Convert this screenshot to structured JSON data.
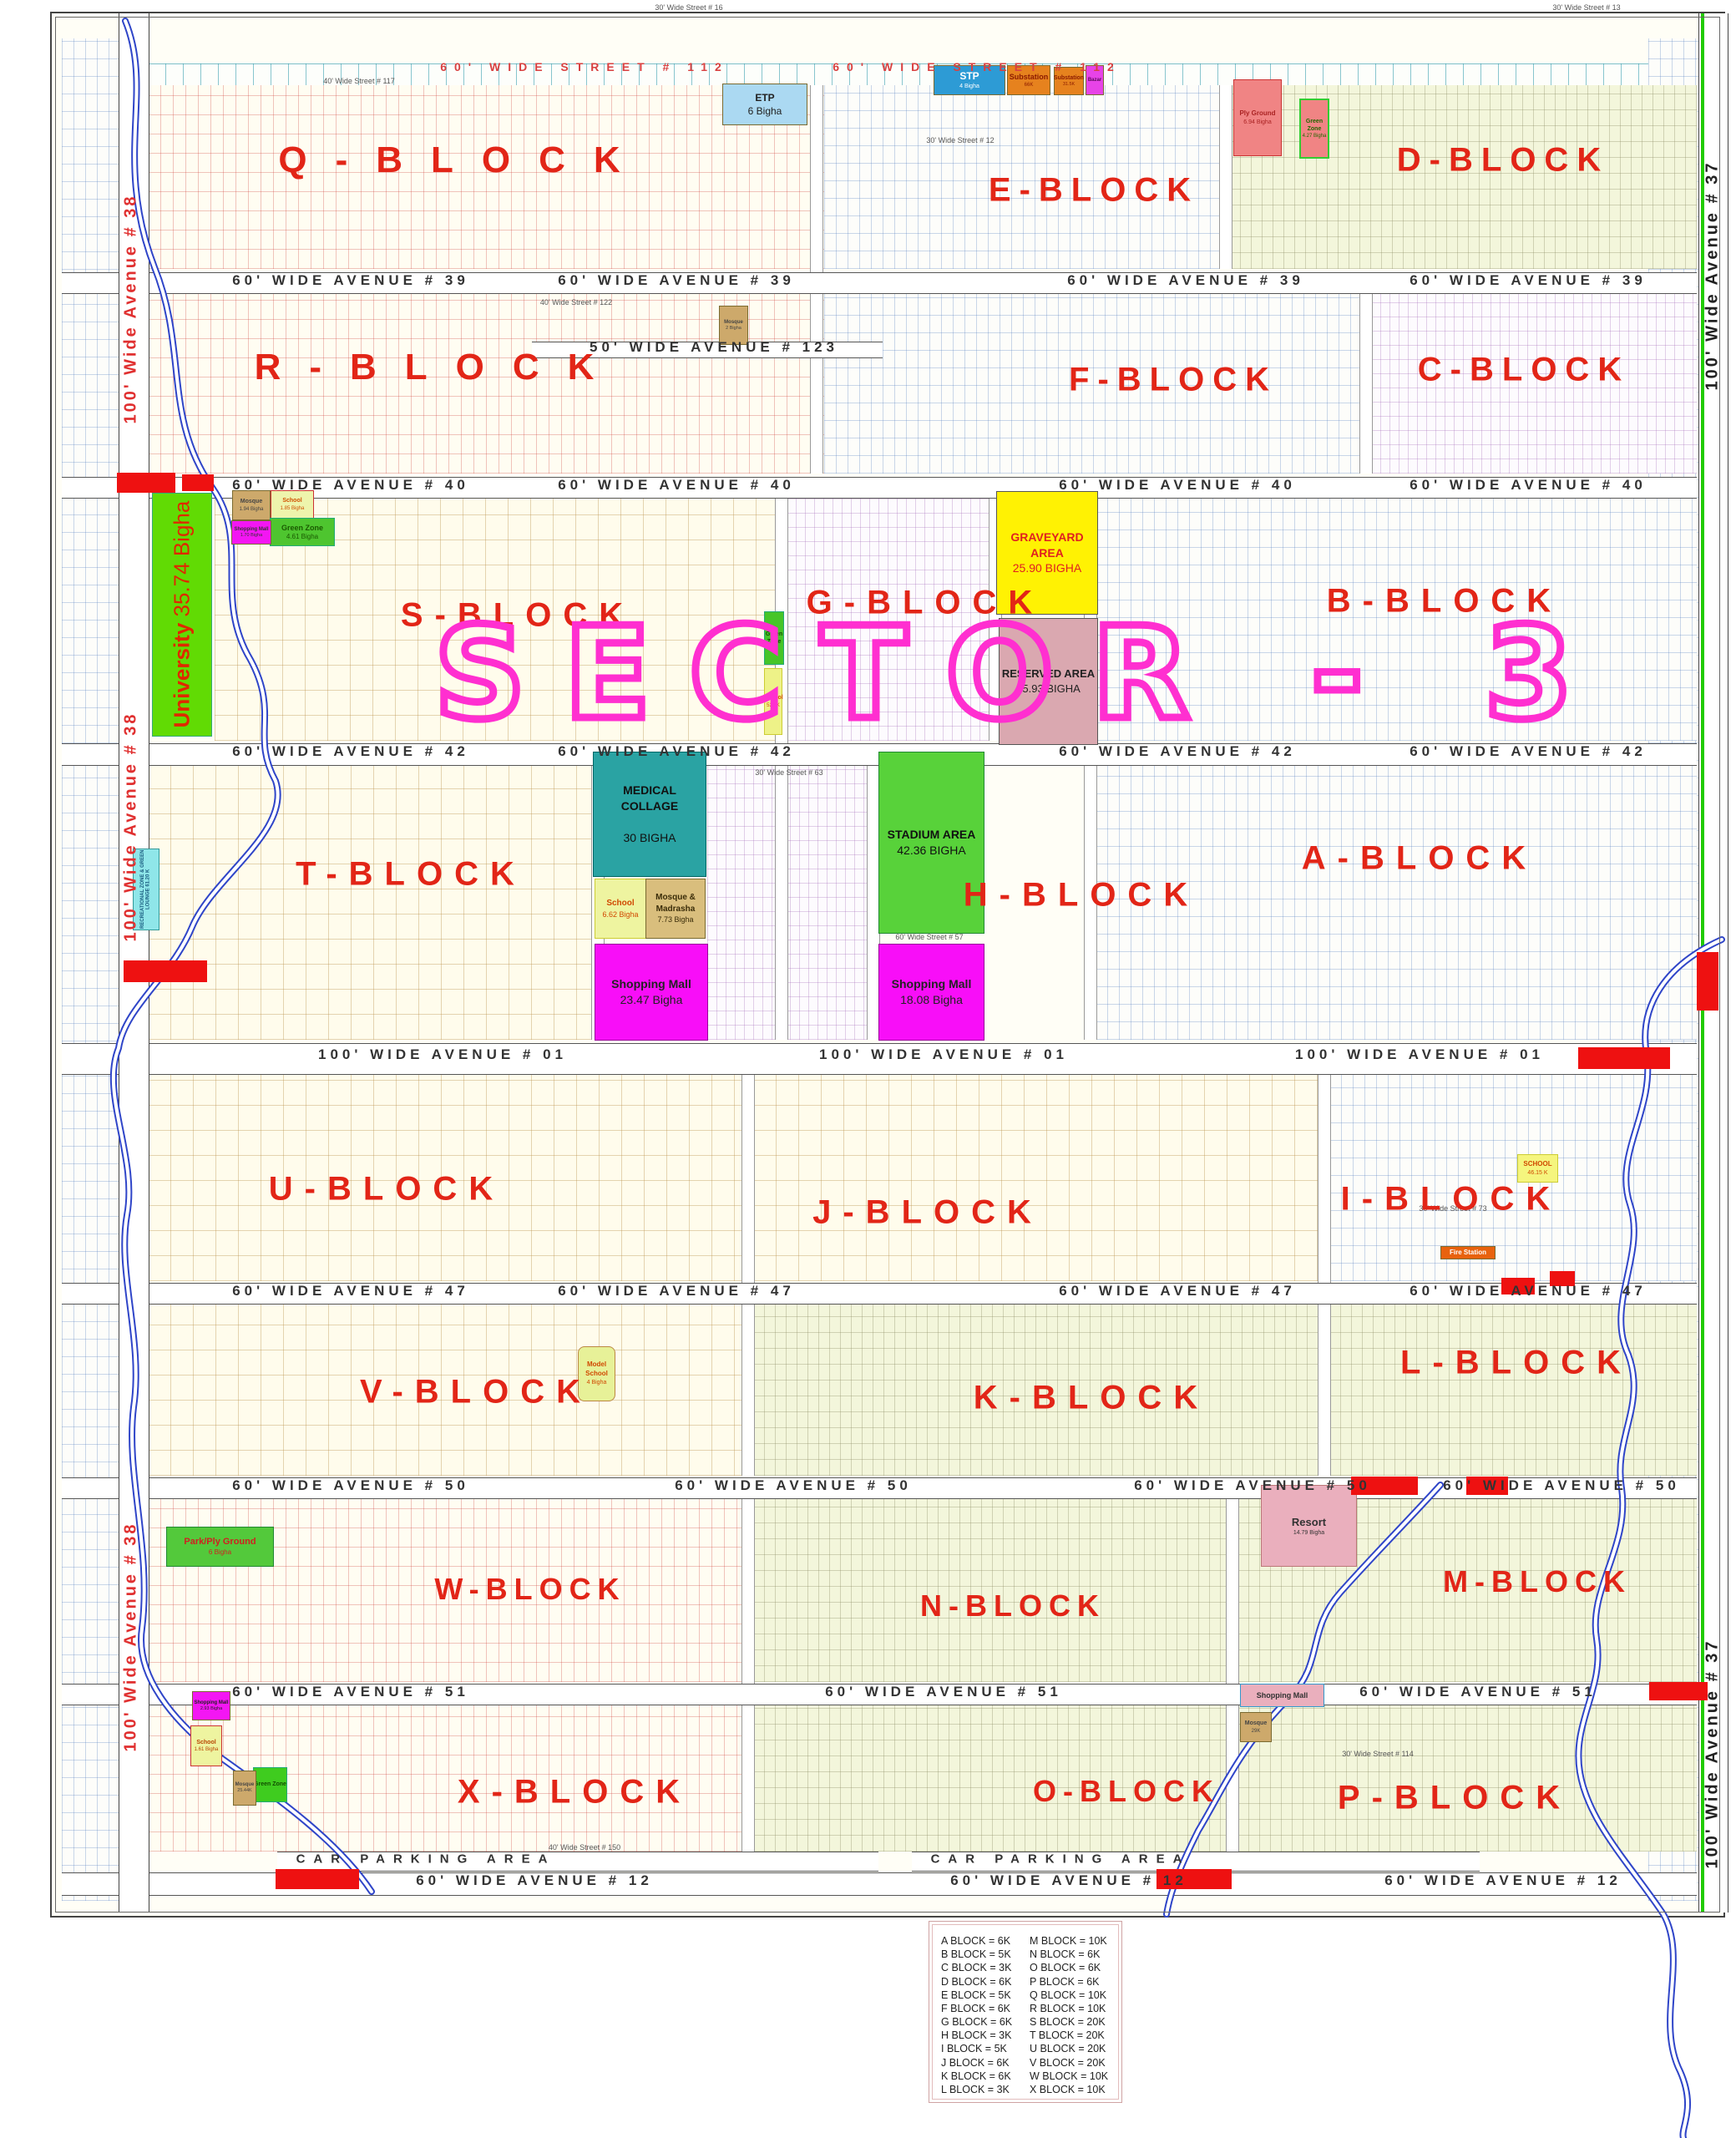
{
  "map": {
    "title": "SECTOR - 3",
    "blocks": [
      {
        "label": "Q-BLOCK"
      },
      {
        "label": "E-BLOCK"
      },
      {
        "label": "D-BLOCK"
      },
      {
        "label": "R-BLOCK"
      },
      {
        "label": "F-BLOCK"
      },
      {
        "label": "C-BLOCK"
      },
      {
        "label": "S-BLOCK"
      },
      {
        "label": "G-BLOCK"
      },
      {
        "label": "B-BLOCK"
      },
      {
        "label": "T-BLOCK"
      },
      {
        "label": "H-BLOCK"
      },
      {
        "label": "A-BLOCK"
      },
      {
        "label": "U-BLOCK"
      },
      {
        "label": "J-BLOCK"
      },
      {
        "label": "I-BLOCK"
      },
      {
        "label": "V-BLOCK"
      },
      {
        "label": "K-BLOCK"
      },
      {
        "label": "L-BLOCK"
      },
      {
        "label": "W-BLOCK"
      },
      {
        "label": "N-BLOCK"
      },
      {
        "label": "M-BLOCK"
      },
      {
        "label": "X-BLOCK"
      },
      {
        "label": "O-BLOCK"
      },
      {
        "label": "P-BLOCK"
      }
    ],
    "avenues": {
      "street112": "60' WIDE STREET # 112",
      "ave39": "60' WIDE AVENUE # 39",
      "ave123": "50' WIDE AVENUE # 123",
      "ave40": "60' WIDE AVENUE # 40",
      "ave42": "60' WIDE AVENUE # 42",
      "ave01": "100' WIDE AVENUE # 01",
      "ave47": "60' WIDE AVENUE # 47",
      "ave50": "60' WIDE AVENUE # 50",
      "ave51": "60' WIDE AVENUE # 51",
      "ave12": "60' WIDE AVENUE # 12",
      "left_vertical": "100' Wide Avenue # 38",
      "right_vertical": "100' Wide Avenue # 37",
      "car_parking": "CAR PARKING AREA"
    },
    "minor_streets": [
      {
        "label": "30' Wide Street # 16"
      },
      {
        "label": "30' Wide Street # 13"
      },
      {
        "label": "30' Wide Street # 12"
      },
      {
        "label": "40' Wide Street # 117"
      },
      {
        "label": "40' Wide Street # 122"
      },
      {
        "label": "30' Wide Street # 63"
      },
      {
        "label": "60' Wide Street # 57"
      },
      {
        "label": "40' Wide Street # 150"
      },
      {
        "label": "30' Wide Street # 114"
      },
      {
        "label": "30' Wide Street # 73"
      }
    ],
    "areas": [
      {
        "label": "ETP",
        "sublabel": "6 Bigha"
      },
      {
        "label": "STP",
        "sublabel": "4 Bigha"
      },
      {
        "label": "Substation",
        "sublabel": "66K"
      },
      {
        "label": "Substation",
        "sublabel": "31.5K"
      },
      {
        "label": "Bazar",
        "sublabel": ""
      },
      {
        "label": "Ply Ground",
        "sublabel": "6.94 Bigha"
      },
      {
        "label": "Green Zone",
        "sublabel": "4.27 Bigha"
      },
      {
        "label": "University",
        "sublabel": "35.74 Bigha"
      },
      {
        "label": "Mosque",
        "sublabel": "1.94 Bigha"
      },
      {
        "label": "School",
        "sublabel": "1.85 Bigha"
      },
      {
        "label": "Green Zone",
        "sublabel": "4.61 Bigha"
      },
      {
        "label": "Shopping Mall",
        "sublabel": "1.70 Bigha"
      },
      {
        "label": "GRAVEYARD AREA",
        "sublabel": "25.90 BIGHA"
      },
      {
        "label": "RESERVED AREA",
        "sublabel": "25.93 BIGHA"
      },
      {
        "label": "MEDICAL COLLAGE",
        "sublabel": "30 BIGHA"
      },
      {
        "label": "School",
        "sublabel": "6.62 Bigha"
      },
      {
        "label": "Mosque & Madrasha",
        "sublabel": "7.73 Bigha"
      },
      {
        "label": "Shopping Mall",
        "sublabel": "23.47 Bigha"
      },
      {
        "label": "STADIUM AREA",
        "sublabel": "42.36 BIGHA"
      },
      {
        "label": "Shopping Mall",
        "sublabel": "18.08 Bigha"
      },
      {
        "label": "Green Zone",
        "sublabel": ""
      },
      {
        "label": "School",
        "sublabel": "52.8K"
      },
      {
        "label": "RECREATIONAL ZONE & GREEN LOUNGE",
        "sublabel": "61.20 K"
      },
      {
        "label": "Model School",
        "sublabel": "4 Bigha"
      },
      {
        "label": "SCHOOL",
        "sublabel": "46.15 K"
      },
      {
        "label": "Fire Station",
        "sublabel": ""
      },
      {
        "label": "Park/Ply Ground",
        "sublabel": "6 Bigha"
      },
      {
        "label": "Resort",
        "sublabel": "14.79 Bigha"
      },
      {
        "label": "Shopping Mall",
        "sublabel": "4.90 Bigha"
      },
      {
        "label": "Mosque",
        "sublabel": "29K"
      },
      {
        "label": "Shopping Mall",
        "sublabel": "2.93 Bigha"
      },
      {
        "label": "School",
        "sublabel": "1.61 Bigha"
      },
      {
        "label": "Green Zone",
        "sublabel": ""
      },
      {
        "label": "Mosque",
        "sublabel": "25.44K"
      },
      {
        "label": "Mosque",
        "sublabel": "2 Bigha"
      }
    ],
    "legend": {
      "lines": [
        "A BLOCK = 6K",
        "B BLOCK = 5K",
        "C BLOCK = 3K",
        "D BLOCK = 6K",
        "E BLOCK = 5K",
        "F BLOCK = 6K",
        "G BLOCK = 6K",
        "H BLOCK = 3K",
        "I BLOCK = 5K",
        "J BLOCK = 6K",
        "K BLOCK = 6K",
        "L BLOCK = 3K",
        "M BLOCK = 10K",
        "N BLOCK = 6K",
        "O BLOCK = 6K",
        "P BLOCK = 6K",
        "Q BLOCK = 10K",
        "R BLOCK = 10K",
        "S BLOCK = 20K",
        "T BLOCK = 20K",
        "U BLOCK = 20K",
        "V BLOCK = 20K",
        "W BLOCK = 10K",
        "X BLOCK = 10K"
      ]
    }
  }
}
